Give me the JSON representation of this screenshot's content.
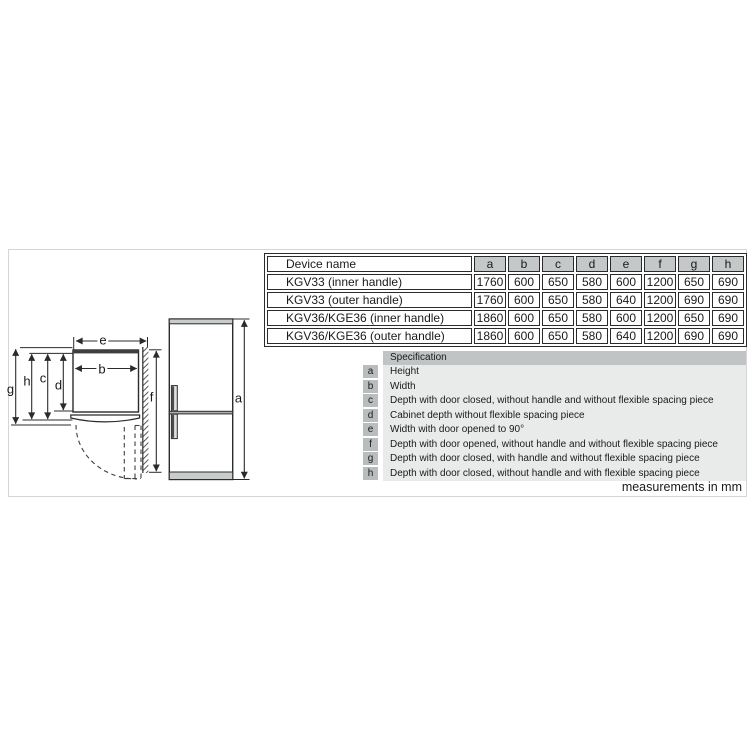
{
  "frame_note": "measurements in mm",
  "table": {
    "header": [
      "Device name",
      "a",
      "b",
      "c",
      "d",
      "e",
      "f",
      "g",
      "h"
    ],
    "rows": [
      {
        "name": "KGV33 (inner handle)",
        "values": [
          "1760",
          "600",
          "650",
          "580",
          "600",
          "1200",
          "650",
          "690"
        ]
      },
      {
        "name": "KGV33 (outer handle)",
        "values": [
          "1760",
          "600",
          "650",
          "580",
          "640",
          "1200",
          "690",
          "690"
        ]
      },
      {
        "name": "KGV36/KGE36 (inner handle)",
        "values": [
          "1860",
          "600",
          "650",
          "580",
          "600",
          "1200",
          "650",
          "690"
        ]
      },
      {
        "name": "KGV36/KGE36 (outer handle)",
        "values": [
          "1860",
          "600",
          "650",
          "580",
          "640",
          "1200",
          "690",
          "690"
        ]
      }
    ]
  },
  "spec": {
    "title": "Specification",
    "rows": [
      {
        "key": "a",
        "text": "Height"
      },
      {
        "key": "b",
        "text": "Width"
      },
      {
        "key": "c",
        "text": "Depth with door closed, without handle and without flexible spacing piece"
      },
      {
        "key": "d",
        "text": "Cabinet depth without flexible spacing piece"
      },
      {
        "key": "e",
        "text": "Width with door opened to 90°"
      },
      {
        "key": "f",
        "text": "Depth with door opened, without handle and without flexible spacing piece"
      },
      {
        "key": "g",
        "text": "Depth with door closed, with handle and without flexible spacing piece"
      },
      {
        "key": "h",
        "text": "Depth with door closed, without handle and with flexible spacing piece"
      }
    ]
  },
  "diagram": {
    "labels": {
      "a": "a",
      "b": "b",
      "c": "c",
      "d": "d",
      "e": "e",
      "f": "f",
      "g": "g",
      "h": "h"
    }
  },
  "colors": {
    "line": "#2b2b2b",
    "table_header_bg": "#c5c8c9",
    "legend_header_bg": "#c0c4c5",
    "legend_body_bg": "#e9ebeb",
    "legend_key_bg": "#b9bdbe",
    "fridge_panel_gray": "#c9cccd",
    "frame_border": "#d5d5d5"
  }
}
